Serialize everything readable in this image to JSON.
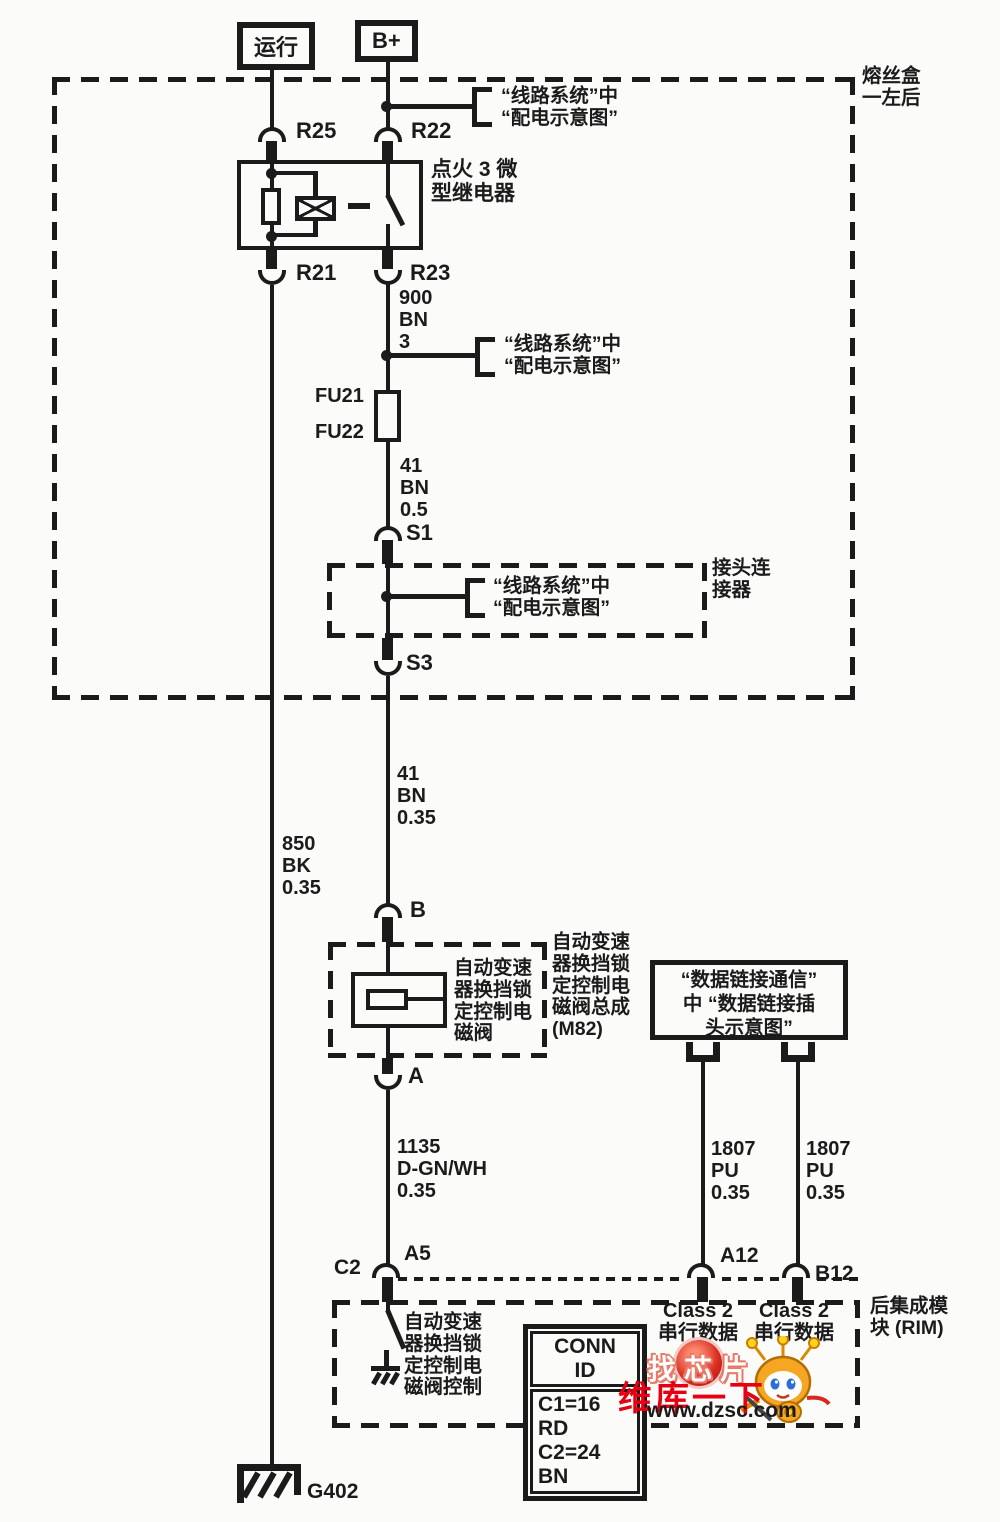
{
  "colors": {
    "ink": "#1b1b1b",
    "paper": "#fbfbf9",
    "watermark_red": "#e60012",
    "mascot_orange": "#f5a623"
  },
  "feeds": {
    "run": "运行",
    "bplus": "B+"
  },
  "fusebox": {
    "label": "熔丝盒\n一左后"
  },
  "relay": {
    "label": "点火 3 微\n型继电器"
  },
  "terminals": {
    "r25": "R25",
    "r22": "R22",
    "r21": "R21",
    "r23": "R23",
    "s1": "S1",
    "s3": "S3",
    "b": "B",
    "a": "A",
    "c2": "C2",
    "a5": "A5",
    "a12": "A12",
    "b12": "B12",
    "fu21": "FU21",
    "fu22": "FU22",
    "g402": "G402"
  },
  "callout": {
    "power_distribution": "“线路系统”中\n“配电示意图”"
  },
  "connector_box": {
    "label": "接头连\n接器"
  },
  "wires": {
    "w900": "900\nBN\n3",
    "w41a": "41\nBN\n0.5",
    "w41b": "41\nBN\n0.35",
    "w850": "850\nBK\n0.35",
    "w1135": "1135\nD-GN/WH\n0.35",
    "w1807a": "1807\nPU\n0.35",
    "w1807b": "1807\nPU\n0.35"
  },
  "m82": {
    "solenoid_label": "自动变速\n器换挡锁\n定控制电\n磁阀",
    "assembly_label": "自动变速\n器换挡锁\n定控制电\n磁阀总成\n(M82)"
  },
  "dlc": {
    "label": "“数据链接通信”\n中 “数据链接插\n头示意图”"
  },
  "rim": {
    "label": "后集成模\n块 (RIM)",
    "control_label": "自动变速\n器换挡锁\n定控制电\n磁阀控制",
    "class2_left": "Class 2\n串行数据",
    "class2_right": "Class 2\n串行数据",
    "conn_id": {
      "title": "CONN ID",
      "row1": "C1=16 RD",
      "row2": "C2=24 BN"
    }
  },
  "watermark": {
    "line1": "找芯片",
    "line2": "维库一下",
    "line3": "www.dzsc.com"
  }
}
